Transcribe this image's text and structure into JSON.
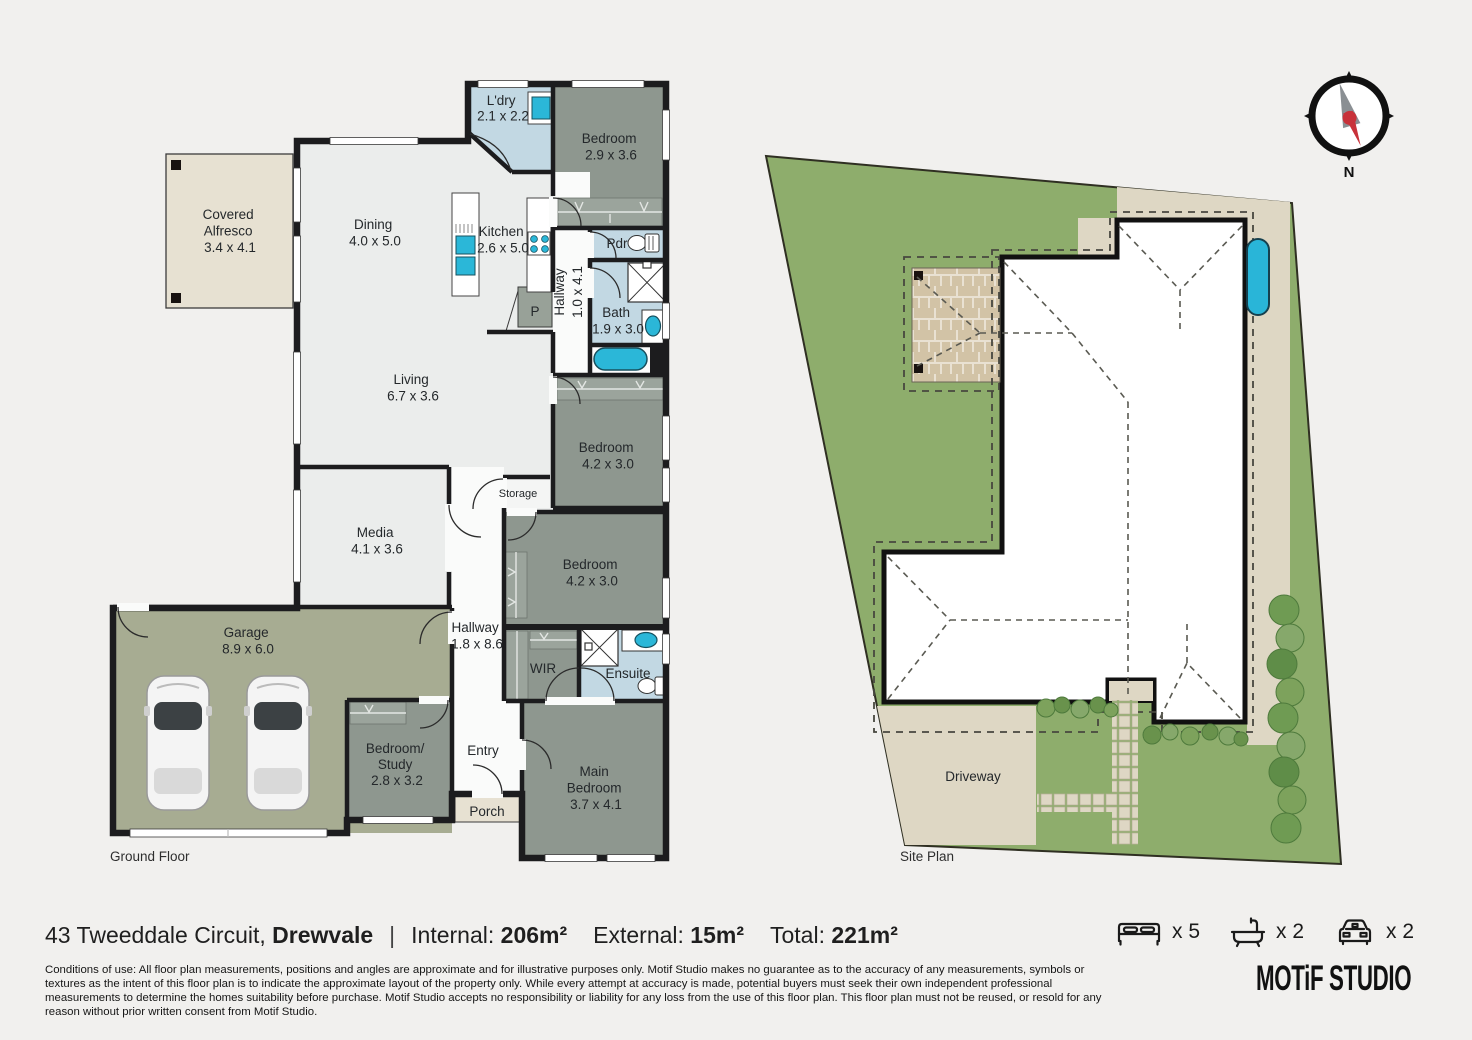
{
  "plan": {
    "caption_ground": "Ground Floor",
    "caption_site": "Site Plan",
    "rooms": {
      "alfresco": {
        "l1": "Covered",
        "l2": "Alfresco",
        "dims": "3.4 x 4.1"
      },
      "dining": {
        "name": "Dining",
        "dims": "4.0 x 5.0"
      },
      "kitchen": {
        "name": "Kitchen",
        "dims": "2.6 x 5.0"
      },
      "laundry": {
        "name": "L'dry",
        "dims": "2.1 x 2.2"
      },
      "bed1": {
        "name": "Bedroom",
        "dims": "2.9 x 3.6"
      },
      "pdr": {
        "name": "Pdr"
      },
      "hall1": {
        "name": "Hallway",
        "dims": "1.0 x 4.1"
      },
      "bath": {
        "name": "Bath",
        "dims": "1.9 x 3.0"
      },
      "living": {
        "name": "Living",
        "dims": "6.7 x 3.6"
      },
      "bed2": {
        "name": "Bedroom",
        "dims": "4.2 x 3.0"
      },
      "storage": {
        "name": "Storage"
      },
      "media": {
        "name": "Media",
        "dims": "4.1 x 3.6"
      },
      "bed3": {
        "name": "Bedroom",
        "dims": "4.2 x 3.0"
      },
      "garage": {
        "name": "Garage",
        "dims": "8.9 x 6.0"
      },
      "hall2": {
        "name": "Hallway",
        "dims": "1.8 x 8.6"
      },
      "wir": {
        "name": "WIR"
      },
      "ensuite": {
        "name": "Ensuite"
      },
      "study": {
        "l1": "Bedroom/",
        "l2": "Study",
        "dims": "2.8 x 3.2"
      },
      "entry": {
        "name": "Entry"
      },
      "main_bed": {
        "l1": "Main",
        "l2": "Bedroom",
        "dims": "3.7 x 4.1"
      },
      "porch": {
        "name": "Porch"
      },
      "pantry": {
        "name": "P"
      }
    },
    "site": {
      "driveway": "Driveway"
    },
    "compass": {
      "north": "N"
    }
  },
  "footer": {
    "address_street": "43 Tweeddale Circuit, ",
    "address_suburb": "Drewvale",
    "sep": "|",
    "internal_label": "Internal: ",
    "internal_value": "206m²",
    "external_label": "External: ",
    "external_value": "15m²",
    "total_label": "Total: ",
    "total_value": "221m²",
    "stats": {
      "beds": "x 5",
      "baths": "x 2",
      "cars": "x 2"
    },
    "brand": "MOTiF STUDIO",
    "disclaimer": "Conditions of use: All floor plan measurements, positions and angles are approximate and for illustrative purposes only. Motif Studio makes no guarantee as to the accuracy of any measurements, symbols or textures as the intent of this floor plan is to indicate the approximate layout of the property only. While every attempt at accuracy is made, potential buyers must seek their own independent professional measurements to determine the homes suitability before purchase. Motif Studio accepts no responsibility or liability for any loss from the use of this floor plan. This floor plan must not be reused, or resold for any reason without prior written consent from Motif Studio."
  },
  "colors": {
    "wall": "#1c1c1e",
    "room_grey_green": "#8e978f",
    "garage_green": "#a7ac92",
    "wet_blue": "#c2d8e3",
    "fixture_cyan": "#2bb7d8",
    "beige": "#e7e1d2",
    "site_grass": "#8ead6c",
    "site_path": "#ded7c4"
  }
}
